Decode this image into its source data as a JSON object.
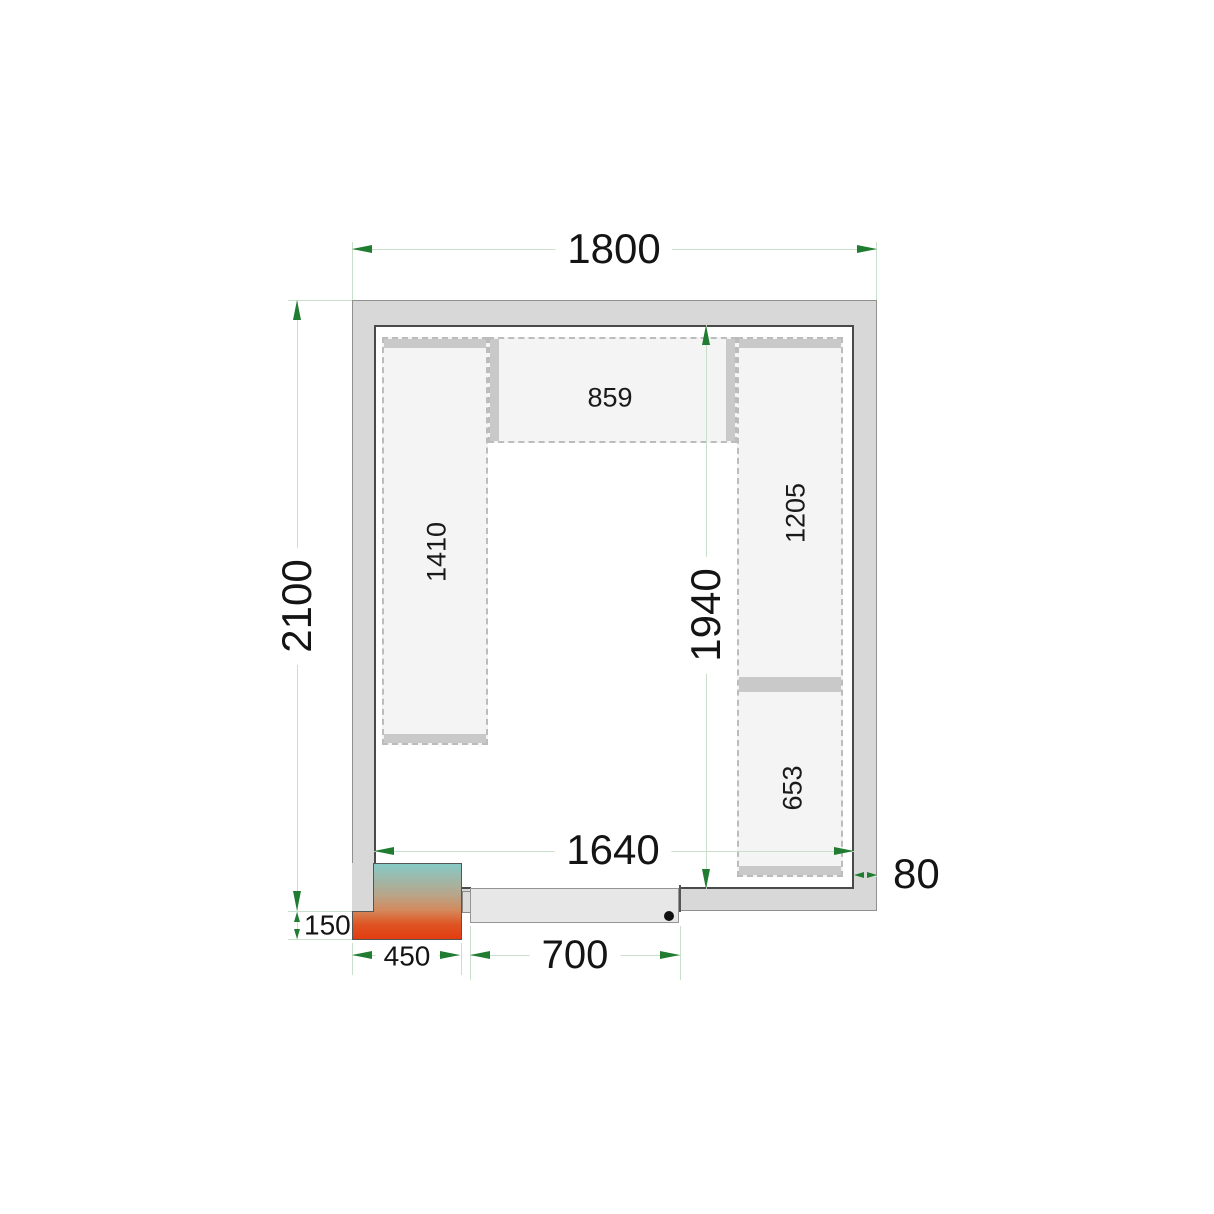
{
  "dimensions": {
    "outer_width": "1800",
    "outer_height": "2100",
    "inner_width": "1640",
    "inner_height": "1940",
    "wall_thickness": "80",
    "unit_width": "450",
    "unit_protrusion": "150",
    "door_width": "700"
  },
  "shelf_labels": {
    "top": "859",
    "left": "1410",
    "right_upper": "1205",
    "right_lower": "653"
  },
  "colors": {
    "dimension_line": "#c8dfc9",
    "dimension_arrow": "#1f7c31",
    "wall_fill": "#d8d8d8",
    "wall_inner_border": "#4a4a4a",
    "shelf_fill": "#f4f4f4",
    "shelf_bar": "#c9c9c9",
    "door_fill": "#e7e7e7",
    "door_handle": "#111111",
    "unit_gradient_top": "#86cac6",
    "unit_gradient_bottom": "#e23c10"
  }
}
